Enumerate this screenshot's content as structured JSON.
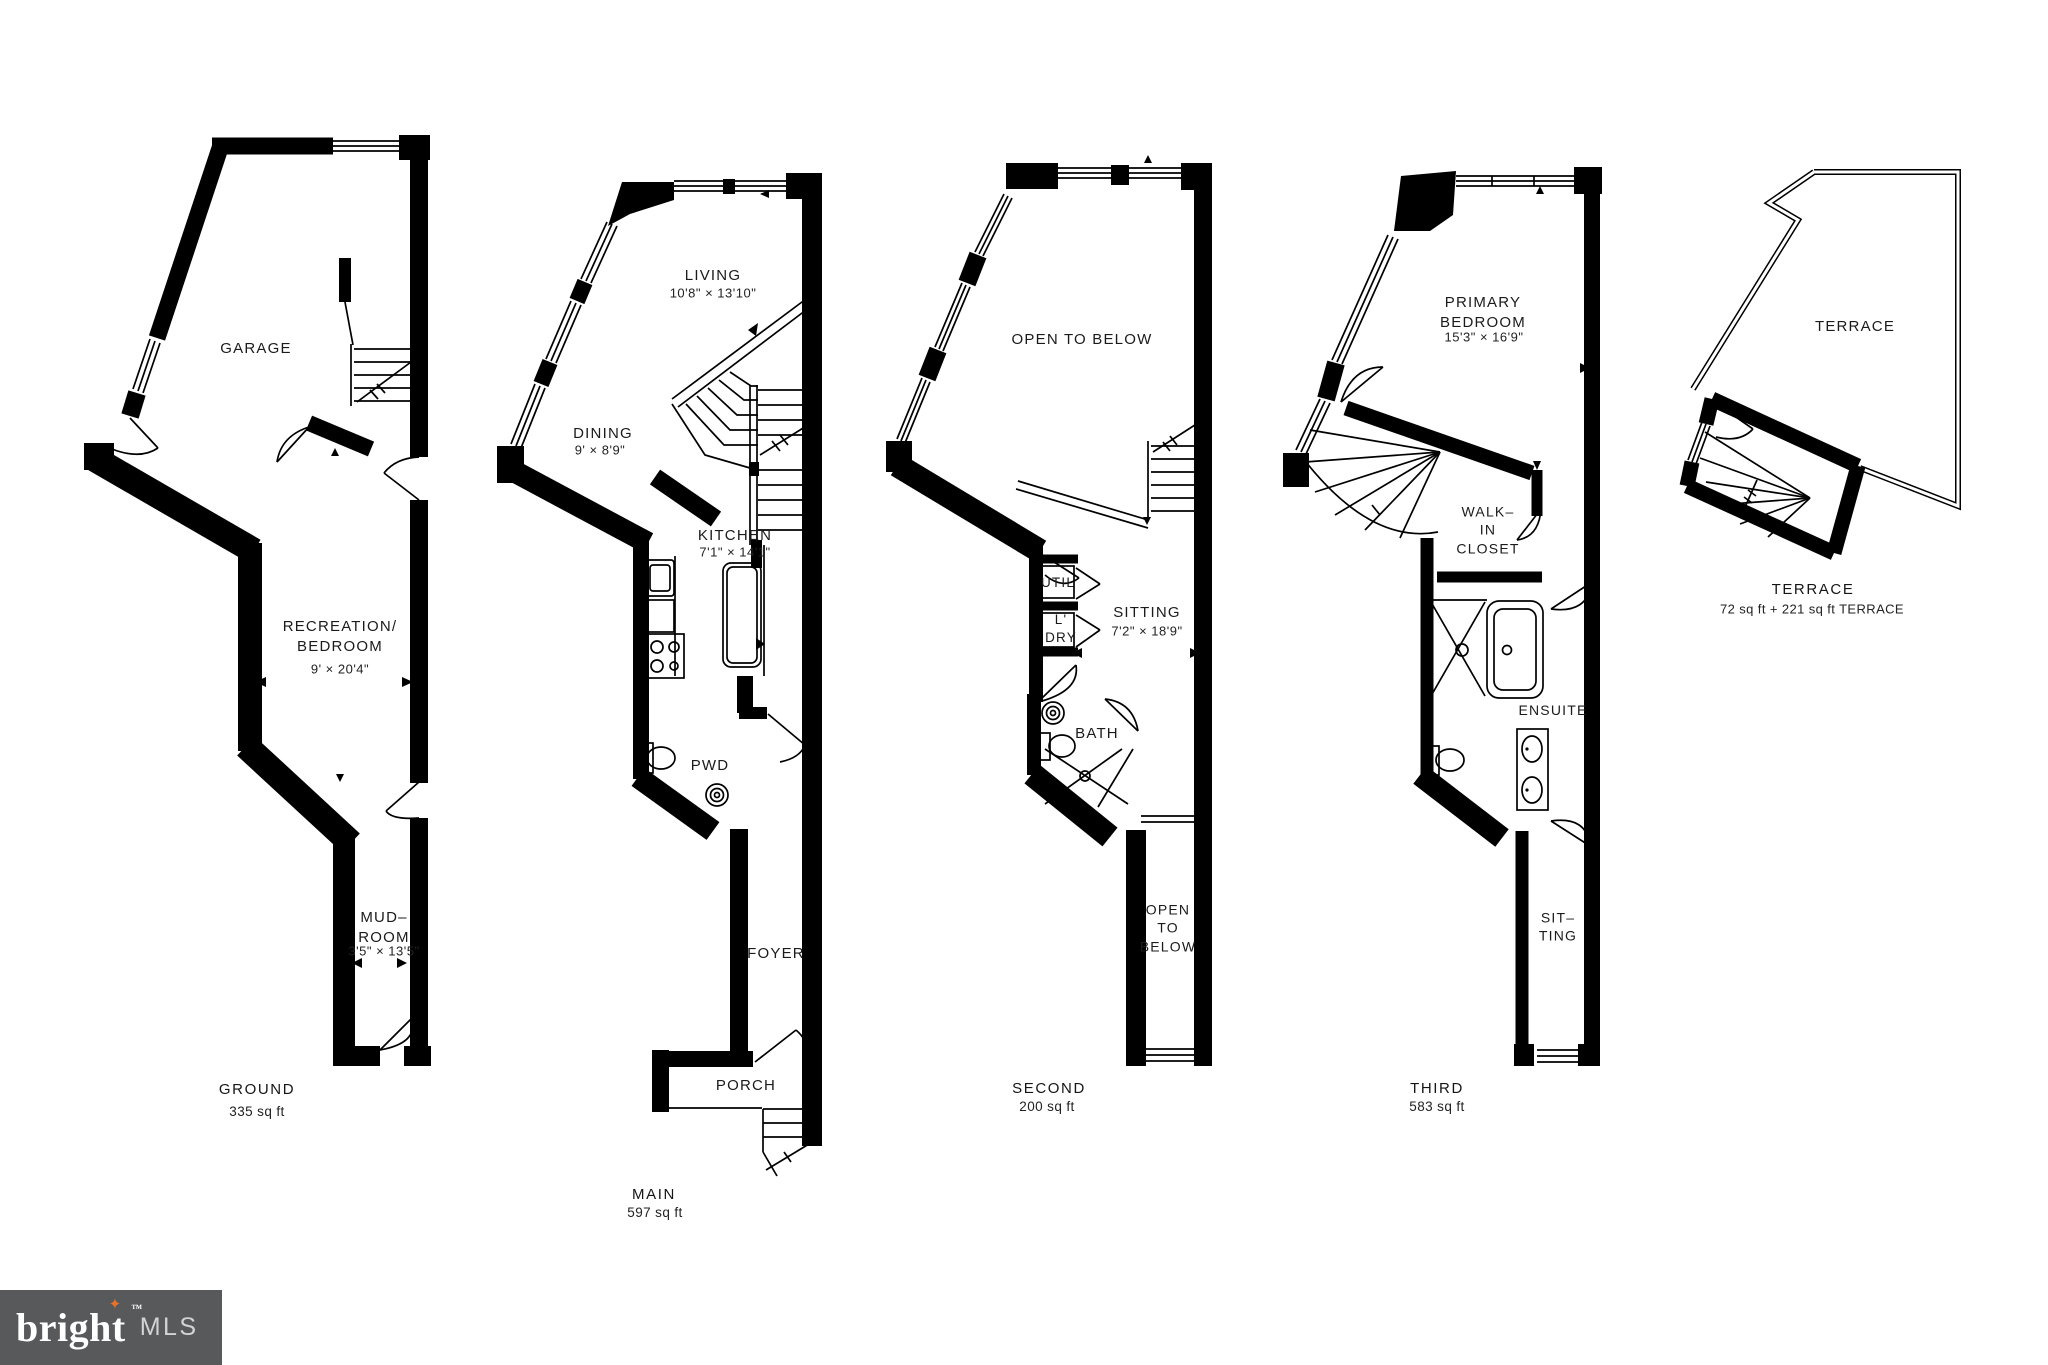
{
  "colors": {
    "walls": "#000000",
    "background": "#ffffff",
    "logo_bg": "#58595b",
    "star": "#e8722a"
  },
  "logo": {
    "brand": "bright",
    "tm": "™",
    "mls": "MLS",
    "star": "✦"
  },
  "floors": {
    "ground": {
      "name": "GROUND",
      "area": "335 sq ft",
      "garage": "GARAGE",
      "rec": "RECREATION/\nBEDROOM",
      "rec_dims": "9' × 20'4\"",
      "mud": "MUD–\nROOM",
      "mud_dims": "3'5\" × 13'5\""
    },
    "main": {
      "name": "MAIN",
      "area": "597 sq ft",
      "living": "LIVING",
      "living_dims": "10'8\" × 13'10\"",
      "dining": "DINING",
      "dining_dims": "9' × 8'9\"",
      "kitchen": "KITCHEN",
      "kitchen_dims": "7'1\" × 14'1\"",
      "pwd": "PWD",
      "foyer": "FOYER",
      "porch": "PORCH"
    },
    "second": {
      "name": "SECOND",
      "area": "200 sq ft",
      "open": "OPEN TO BELOW",
      "util": "UTIL",
      "ldry": "L'\nDRY",
      "sitting": "SITTING",
      "sitting_dims": "7'2\" × 18'9\"",
      "bath": "BATH",
      "open_corridor": "OPEN\nTO\nBELOW"
    },
    "third": {
      "name": "THIRD",
      "area": "583 sq ft",
      "primary": "PRIMARY\nBEDROOM",
      "primary_dims": "15'3\" × 16'9\"",
      "closet": "WALK–\nIN\nCLOSET",
      "ensuite": "ENSUITE",
      "sitting": "SIT–\nTING"
    },
    "terrace": {
      "name": "TERRACE",
      "area": "72 sq ft + 221 sq ft TERRACE",
      "terrace": "TERRACE"
    }
  }
}
